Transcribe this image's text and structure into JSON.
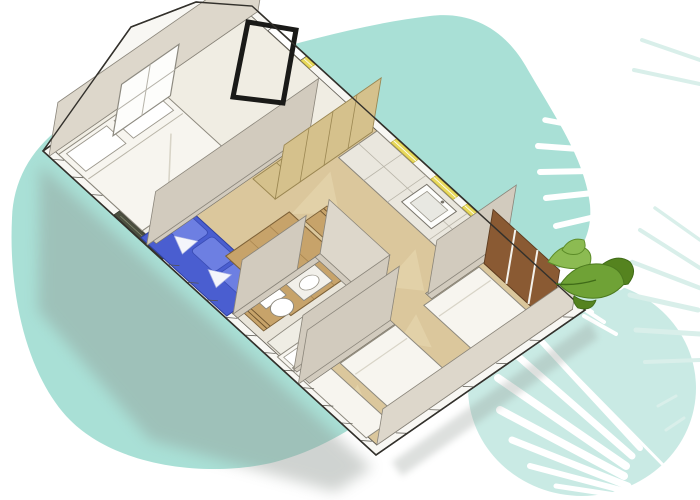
{
  "scene": {
    "type": "3d-floorplan-illustration",
    "background": "#ffffff",
    "orientation": "rotated-isometric, long axis running from upper-left to lower-right"
  },
  "palette": {
    "blob_teal": "#a9e0d6",
    "blob_teal_light": "#c3e8e1",
    "frond_white": "#ffffff",
    "frond_teal_faint": "#d9efea",
    "leaf_green_dark": "#55831f",
    "leaf_green_mid": "#6fa236",
    "leaf_green_light": "#8cbb52",
    "outline_dark": "#33312c",
    "wall_top_white": "#f8f7f3",
    "wall_face_grey": "#d2cbbe",
    "wall_face_light": "#ddd7cb",
    "floor_wood_tan": "#dbc79c",
    "floor_patch_light": "#e9dab2",
    "floor_light": "#f0ede3",
    "bathroom_floor": "#e9e5da",
    "bed_white": "#f7f5ef",
    "sofa_blue": "#4a5ed0",
    "sofa_blue_light": "#6d7fe2",
    "table_wood": "#c7a36a",
    "cabinet_tan": "#d5c18c",
    "wardrobe_brown": "#8a5a33",
    "louver_yellow": "#e8d95c",
    "counter_grey": "#eae7de",
    "shadow_grey": "#8f9792",
    "door_frame_black": "#1a1a18"
  },
  "floorplan": {
    "style": "isometric-cutaway mobile-home",
    "rooms": [
      {
        "name": "master-bedroom",
        "furniture": [
          "double-bed",
          "white-pillows",
          "gable-window",
          "tall-shelf-unit"
        ]
      },
      {
        "name": "entry-hall",
        "furniture": [
          "black-door-frame",
          "entry-opening"
        ]
      },
      {
        "name": "living-dining",
        "furniture": [
          "blue-sofa",
          "blue-cushions",
          "dining-table",
          "wooden-chair",
          "wooden-chair",
          "louver-vent"
        ]
      },
      {
        "name": "kitchen",
        "furniture": [
          "counter-run",
          "sink",
          "yellow-louver-windows"
        ]
      },
      {
        "name": "bathroom",
        "furniture": [
          "toilet",
          "vanity-sink",
          "shower-tray"
        ]
      },
      {
        "name": "kids-bedroom",
        "furniture": [
          "single-bed",
          "single-bed",
          "single-bed",
          "chest-of-drawers",
          "brown-wardrobe"
        ]
      }
    ],
    "exterior_features": [
      "gable-roof-edge",
      "hatched-exterior-wall-band",
      "white-wall-tops",
      "drop-shadow"
    ]
  },
  "decor": {
    "background_shapes": [
      "large-teal-blob-left",
      "light-teal-circle-bottom-right"
    ],
    "plants": [
      "white-palm-frond-top-right",
      "white-palm-frond-bottom-right",
      "faint-teal-frond-right-edge",
      "green-leaf-cluster"
    ]
  }
}
